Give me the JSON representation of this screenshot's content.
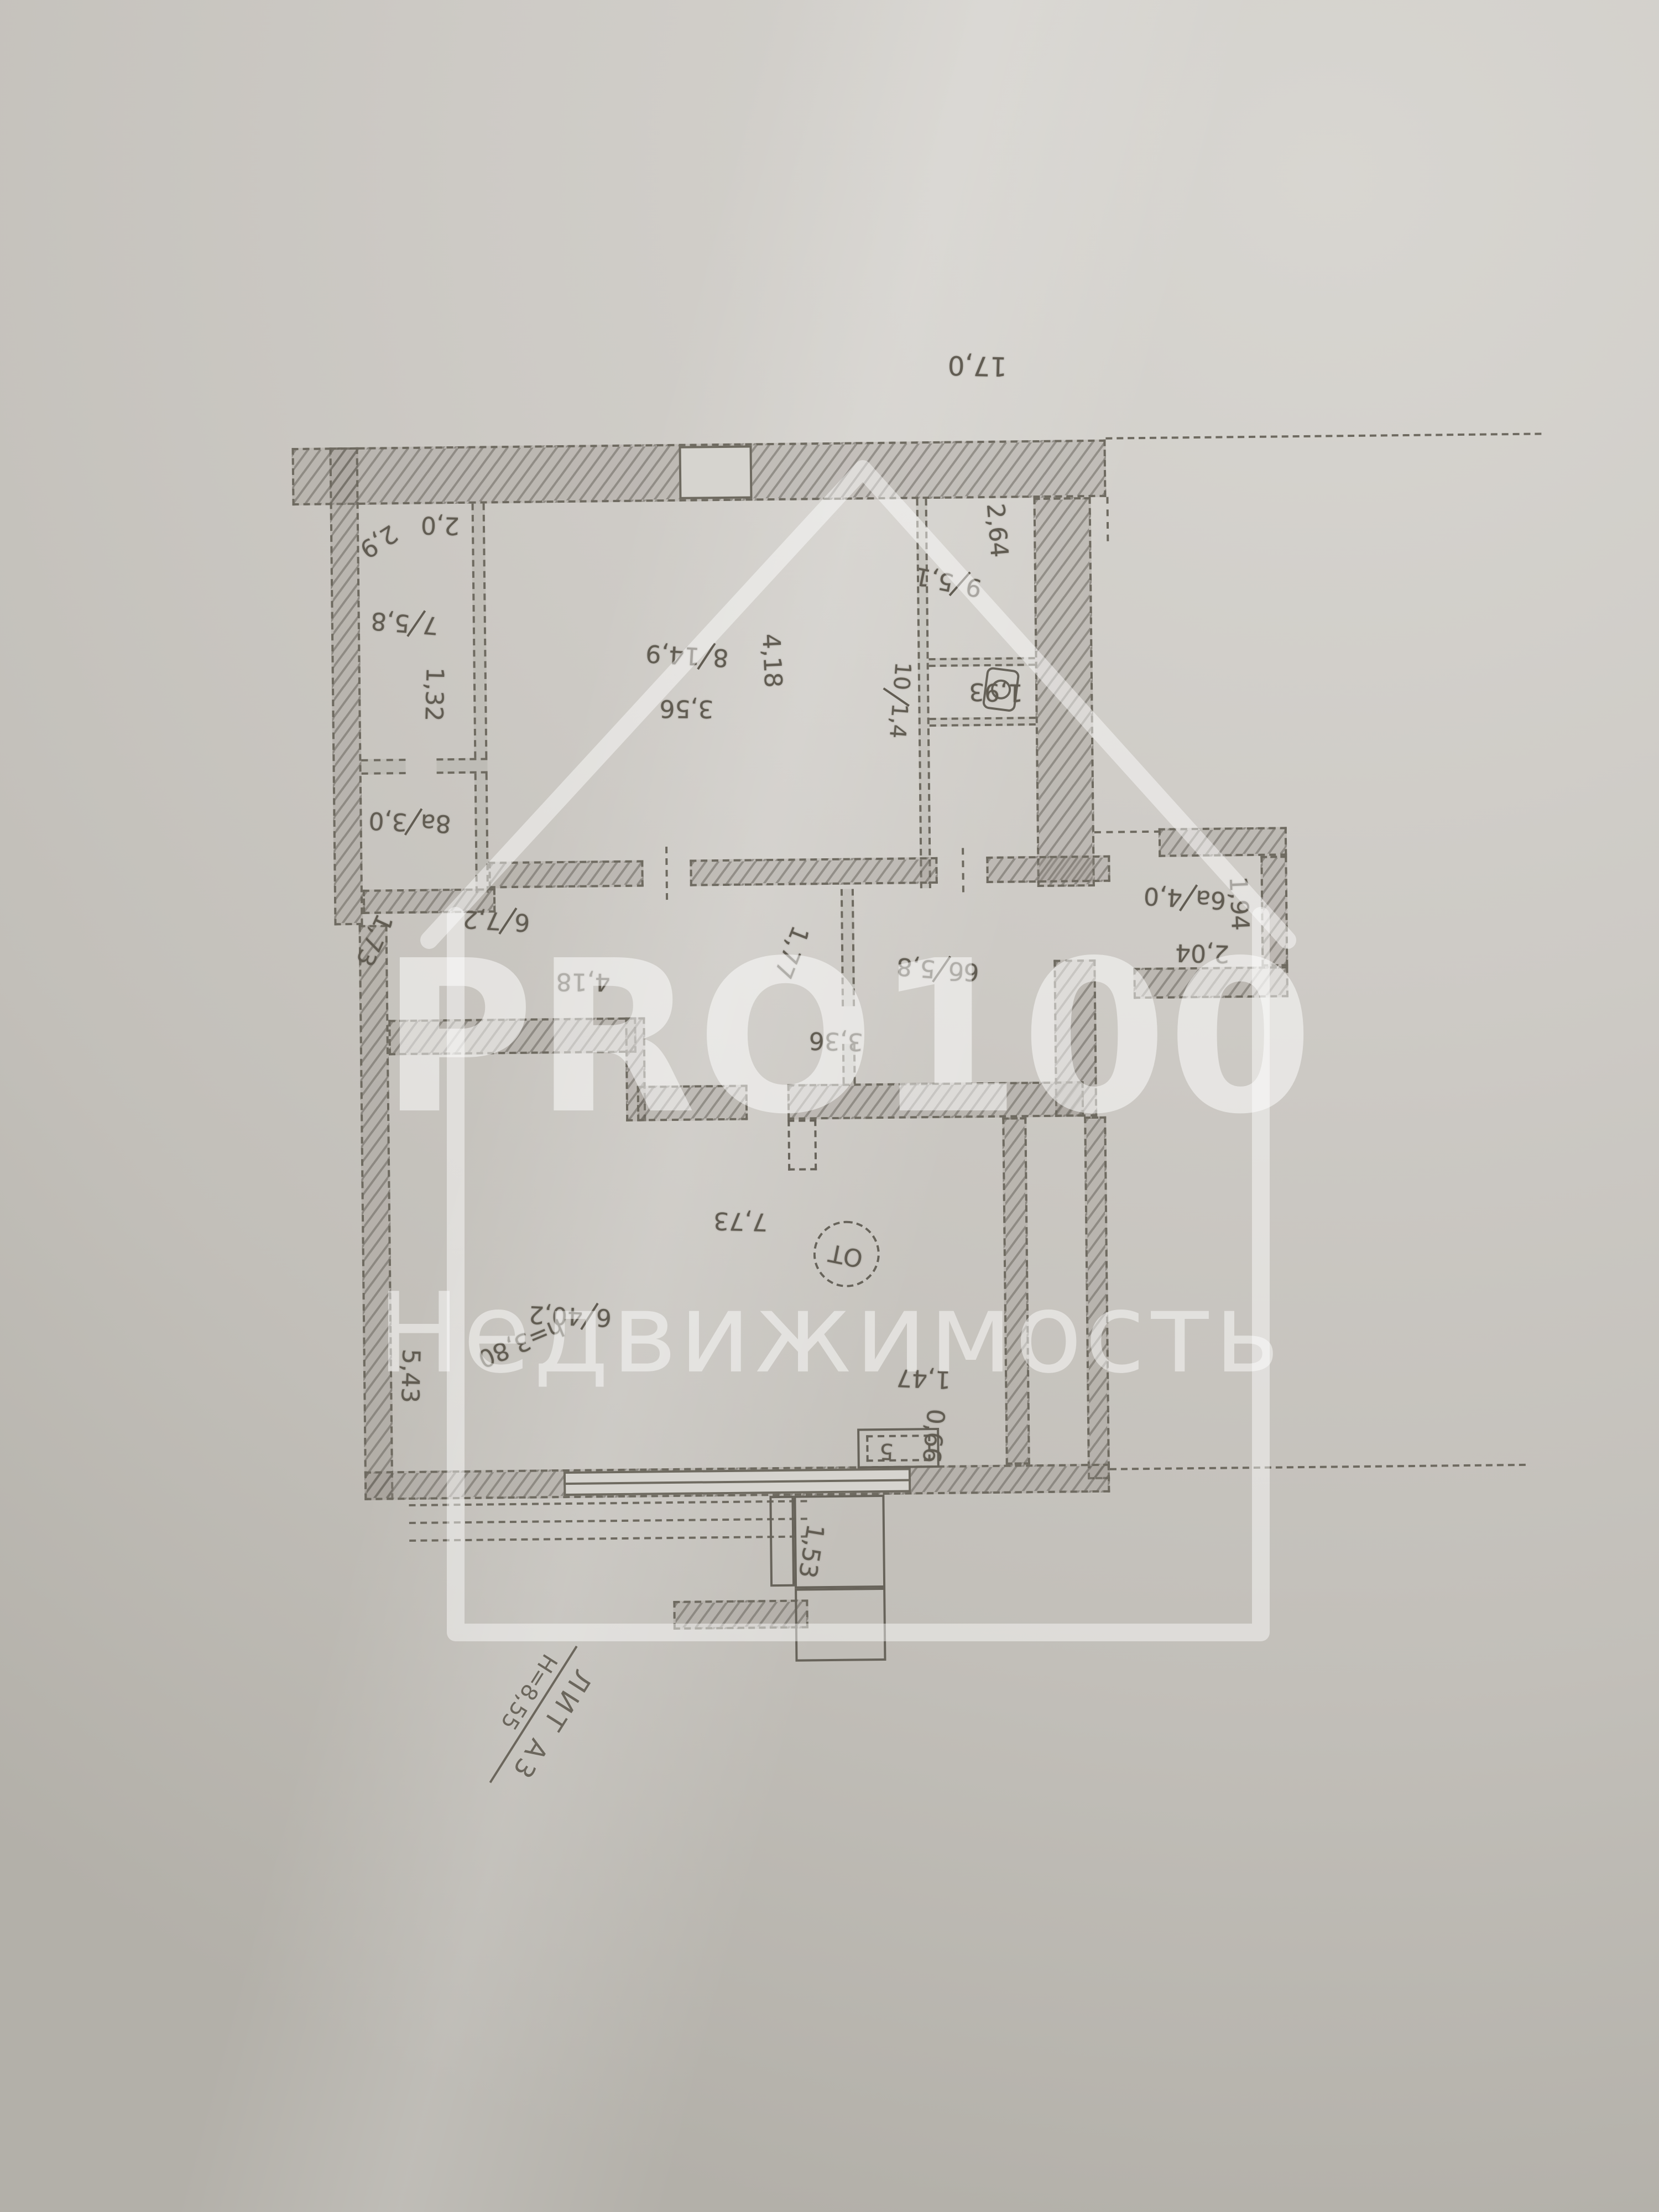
{
  "watermark": {
    "brand": "PRO100",
    "subtitle": "Недвижимость"
  },
  "plan": {
    "overall_width": "17,0",
    "rooms": [
      {
        "num": "7",
        "area": "5,8"
      },
      {
        "num": "8а",
        "area": "3,0"
      },
      {
        "num": "8",
        "area": "14,9"
      },
      {
        "num": "9",
        "area": "5,1"
      },
      {
        "num": "10",
        "area": "1,4"
      },
      {
        "num": "6",
        "area": "7,2"
      },
      {
        "num": "6б",
        "area": "5,8"
      },
      {
        "num": "6а",
        "area": "4,0"
      },
      {
        "num": "6",
        "area": "40,2"
      }
    ],
    "dims": {
      "r7_width": "2,0",
      "r7_depth": "2,9",
      "r8a_width": "1,32",
      "r8_width": "3,56",
      "r8_depth": "4,18",
      "r9_depth": "2,64",
      "r9_width": "1,93",
      "r6_left": "1,73",
      "r6_width": "4,18",
      "r6_door": "1,77",
      "r6_right": "3,36",
      "r6a_depth": "1,94",
      "r6a_width": "2,04",
      "hall_width": "7,73",
      "hall_depth": "5,43",
      "hall_ceiling": "h=3,80",
      "stove_offset": "1,47",
      "stove_depth": "0,66",
      "chimney_offset": "1,53"
    },
    "stove_label": "5",
    "stamp": "ОТ",
    "footer": {
      "liter": "ЛИТ А3",
      "building_height": "Н=8,55"
    }
  }
}
